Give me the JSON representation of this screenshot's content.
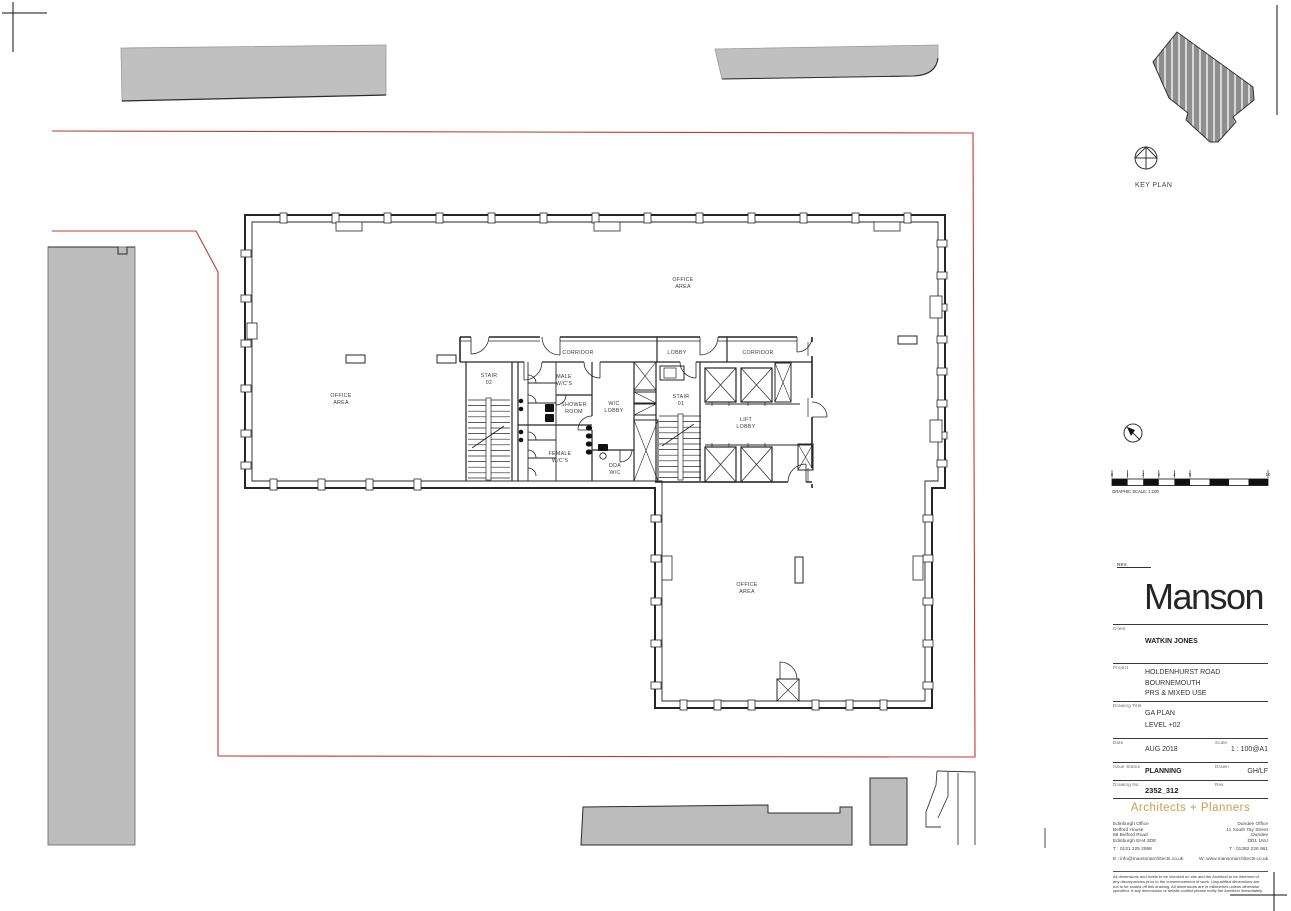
{
  "plan": {
    "rooms": {
      "office": [
        "OFFICE",
        "AREA"
      ],
      "corridor": "CORRIDOR",
      "lobby": "LOBBY",
      "stair02": [
        "STAIR",
        "02"
      ],
      "stair01": [
        "STAIR",
        "01"
      ],
      "male_wc": [
        "MALE",
        "W/C'S"
      ],
      "shower": [
        "SHOWER",
        "ROOM"
      ],
      "wc_lobby": [
        "W/C",
        "LOBBY"
      ],
      "female_wc": [
        "FEMALE",
        "W/C'S"
      ],
      "dda_wc": [
        "DDA",
        "W/C"
      ],
      "lift_lobby": [
        "LIFT",
        "LOBBY"
      ]
    }
  },
  "key_plan": {
    "label": "KEY PLAN"
  },
  "scale_bar": {
    "caption": "GRAPHIC SCALE: 1:100",
    "ticks": [
      "0",
      "1",
      "2",
      "3",
      "4",
      "5",
      "10"
    ]
  },
  "title_block": {
    "rev_label": "REV.",
    "logo": "Manson",
    "client_label": "Client",
    "client": "WATKIN JONES",
    "project_label": "Project",
    "project_lines": [
      "HOLDENHURST ROAD",
      "BOURNEMOUTH",
      "PRS & MIXED USE"
    ],
    "drawing_title_label": "Drawing Title",
    "drawing_title_lines": [
      "GA PLAN",
      "LEVEL +02"
    ],
    "date_label": "Date",
    "date": "AUG 2018",
    "scale_label": "Scale",
    "scale": "1 : 100@A1",
    "issue_status_label": "Issue Status",
    "issue_status": "PLANNING",
    "drawn_label": "Drawn",
    "drawn": "GH/LF",
    "drawing_no_label": "Drawing No.",
    "drawing_no": "2352_312",
    "rev_col_label": "Rev.",
    "tagline": "Architects + Planners",
    "offices": {
      "edinburgh": {
        "lines": [
          "Edinburgh Office",
          "Belford House",
          "58 Belford Road",
          "Edinburgh EH4 3DE"
        ],
        "tel": "T : 0131 225 2958",
        "email": "E : info@mansonarchitects.co.uk"
      },
      "dundee": {
        "lines": [
          "Dundee Office",
          "11 South Tay Street",
          "Dundee",
          "DD1 1NU"
        ],
        "tel": "T : 01382 226 961",
        "web": "W: www.mansonarchitects.co.uk"
      }
    },
    "disclaimer": "All dimensions and levels to be checked on site and the Architect to be informed of any discrepancies prior to the commencement of work. Unqualified dimensions are not to be scaled off this drawing. All dimensions are in millimetres unless otherwise specified. If any dimensions or details conflict please notify the Architect immediately."
  },
  "colors": {
    "boundary_red": "#c0392b",
    "context_gray": "#c0c0c0",
    "keyplan_gray": "#8f8f8f",
    "line": "#262626",
    "gold": "#c3a14f"
  }
}
